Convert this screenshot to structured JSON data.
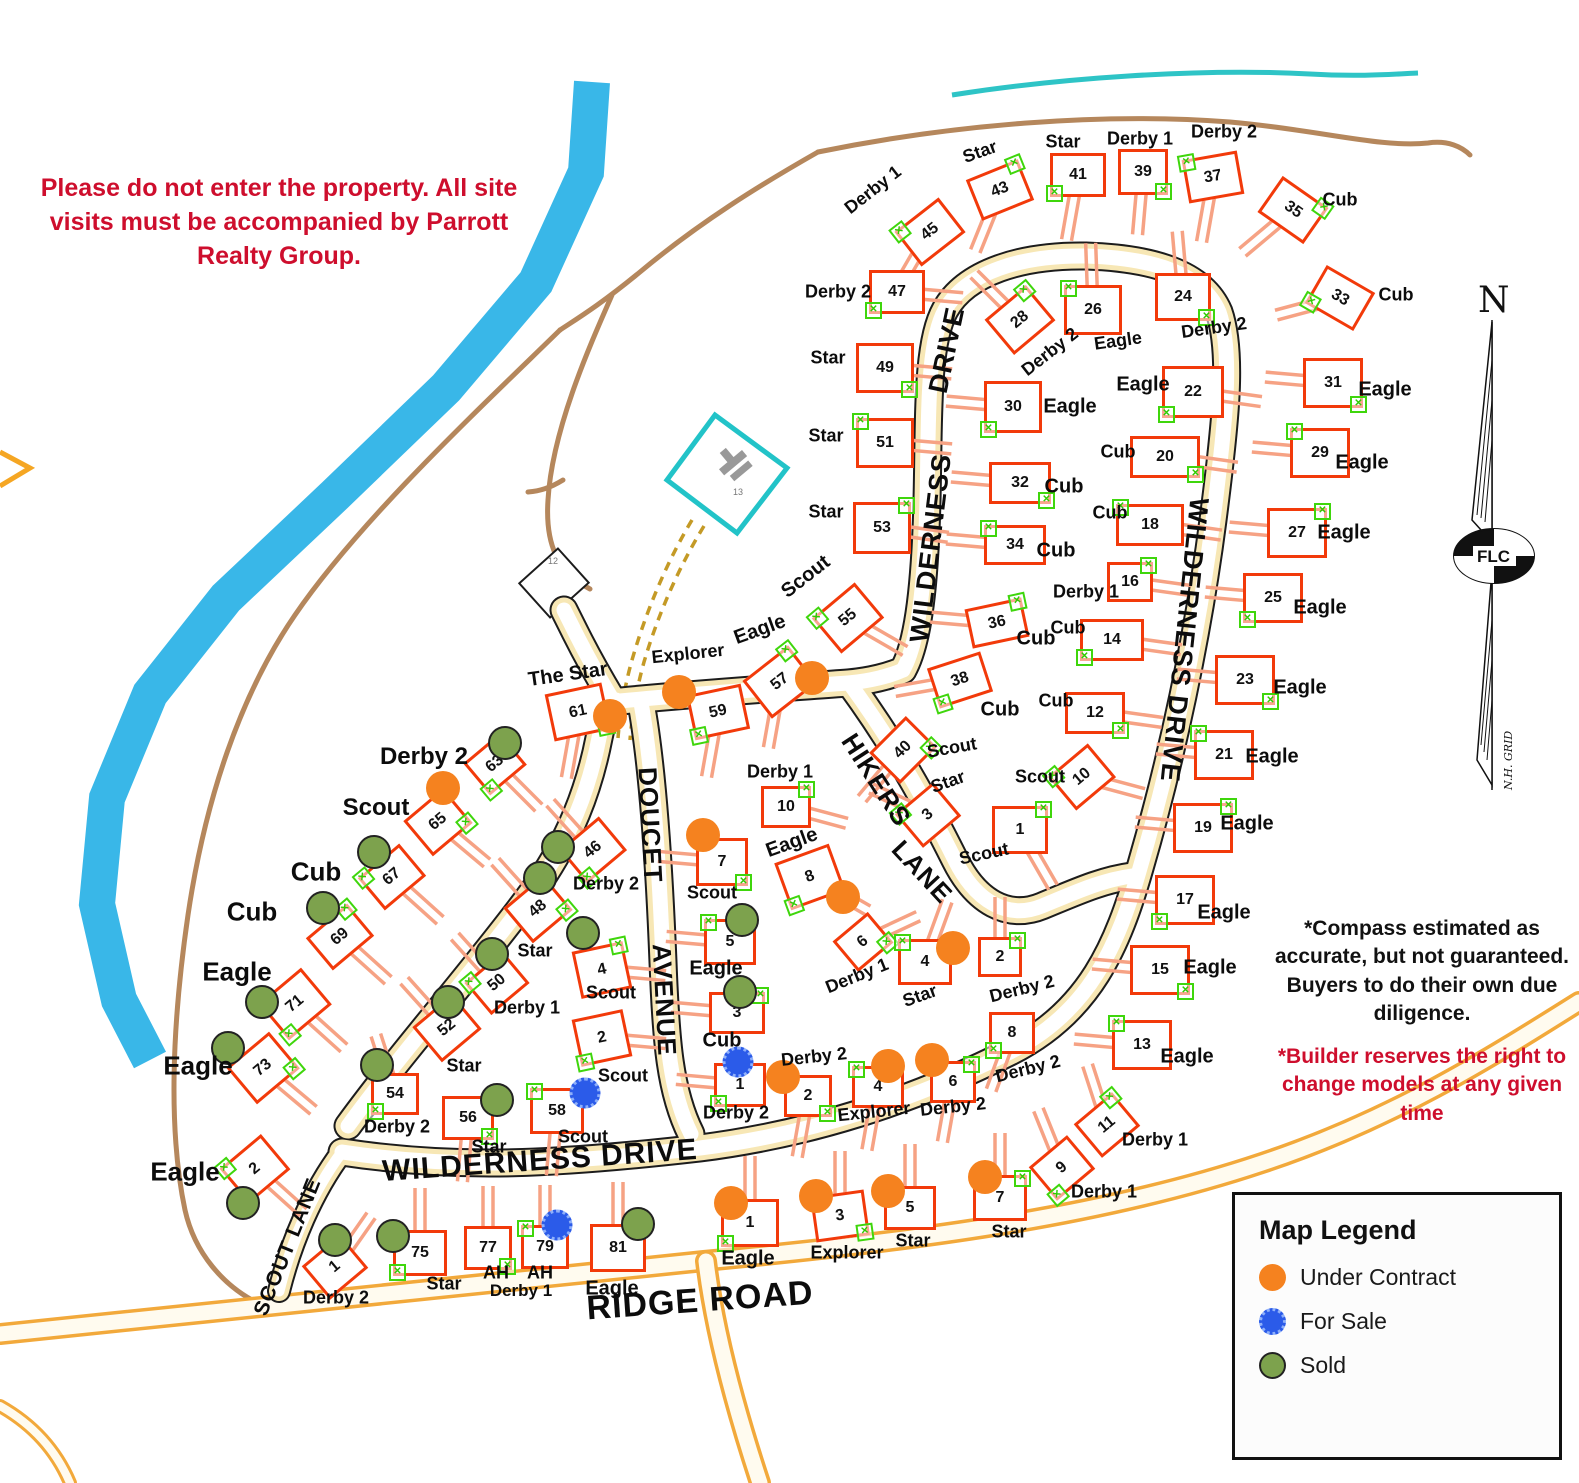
{
  "notices": {
    "entry": "Please do not enter the property. All site visits must be accompanied by Parrott Realty Group.",
    "compass_note": "*Compass estimated as accurate, but not guaranteed. Buyers to do their own due diligence.",
    "builder_note": "*Builder reserves the right to change models at any given time"
  },
  "legend": {
    "title": "Map Legend",
    "items": [
      {
        "label": "Under Contract",
        "color": "#F5821F",
        "style": "solid"
      },
      {
        "label": "For Sale",
        "color": "#2B5BE9",
        "style": "spiky"
      },
      {
        "label": "Sold",
        "color": "#7DA24D",
        "style": "outlined"
      }
    ]
  },
  "compass": {
    "north": "N",
    "oval": "FLC",
    "grid": "N.H. GRID"
  },
  "colors": {
    "house_outline": "#F23A0A",
    "driveway": "#F6A284",
    "river": "#39B7E8",
    "trail": "#B5875C",
    "stream": "#2EC4C6",
    "pond": "#22C3C8"
  },
  "road_labels": [
    {
      "t": "WILDERNESS DRIVE",
      "x": 540,
      "y": 1161,
      "r": -4,
      "s": 30
    },
    {
      "t": "WILDERNESS",
      "x": 931,
      "y": 548,
      "r": -83,
      "s": 27
    },
    {
      "t": "DRIVE",
      "x": 947,
      "y": 350,
      "r": -78,
      "s": 27
    },
    {
      "t": "WILDERNESS DRIVE",
      "x": 1184,
      "y": 640,
      "r": 96,
      "s": 27
    },
    {
      "t": "DOUCET",
      "x": 650,
      "y": 825,
      "r": 87,
      "s": 26
    },
    {
      "t": "AVENUE",
      "x": 664,
      "y": 1000,
      "r": 87,
      "s": 26
    },
    {
      "t": "HIKERS",
      "x": 876,
      "y": 780,
      "r": 57,
      "s": 26
    },
    {
      "t": "LANE",
      "x": 922,
      "y": 872,
      "r": 47,
      "s": 26
    },
    {
      "t": "SCOUT LANE",
      "x": 288,
      "y": 1247,
      "r": -68,
      "s": 21
    },
    {
      "t": "RIDGE ROAD",
      "x": 700,
      "y": 1301,
      "r": -4,
      "s": 34
    }
  ],
  "annotations": [
    {
      "t": "Derby 1",
      "x": 521,
      "y": 1291,
      "s": 17,
      "c": "#0d0d0d",
      "b": true
    },
    {
      "t": "12",
      "x": 553,
      "y": 561,
      "s": 9,
      "c": "#777",
      "b": false
    },
    {
      "t": "13",
      "x": 738,
      "y": 492,
      "s": 9,
      "c": "#777",
      "b": false
    }
  ],
  "lots": [
    {
      "n": "45",
      "m": "Derby 1",
      "x": 930,
      "y": 232,
      "r": -38,
      "da": 120,
      "lx": 873,
      "ly": 190,
      "lr": -38
    },
    {
      "n": "43",
      "m": "Star",
      "x": 1000,
      "y": 190,
      "r": -22,
      "da": 112,
      "lx": 980,
      "ly": 152,
      "lr": -20
    },
    {
      "n": "41",
      "m": "Star",
      "x": 1078,
      "y": 175,
      "r": 0,
      "da": 100,
      "lx": 1063,
      "ly": 142
    },
    {
      "n": "39",
      "m": "Derby 1",
      "x": 1143,
      "y": 172,
      "r": 0,
      "w": 50,
      "h": 46,
      "da": 95,
      "lx": 1140,
      "ly": 139
    },
    {
      "n": "37",
      "m": "Derby 2",
      "x": 1213,
      "y": 177,
      "r": -10,
      "da": 100,
      "lx": 1224,
      "ly": 132
    },
    {
      "n": "35",
      "m": "Cub",
      "x": 1293,
      "y": 210,
      "r": 35,
      "da": 140,
      "lx": 1340,
      "ly": 200
    },
    {
      "n": "33",
      "m": "Cub",
      "x": 1340,
      "y": 298,
      "r": 30,
      "da": 165,
      "lx": 1396,
      "ly": 295
    },
    {
      "n": "31",
      "m": "Eagle",
      "x": 1333,
      "y": 383,
      "r": 0,
      "w": 60,
      "h": 50,
      "da": 185,
      "lx": 1385,
      "ly": 390,
      "ls": 20
    },
    {
      "n": "29",
      "m": "Eagle",
      "x": 1320,
      "y": 453,
      "r": 0,
      "w": 60,
      "h": 50,
      "da": 185,
      "lx": 1362,
      "ly": 463,
      "ls": 20
    },
    {
      "n": "27",
      "m": "Eagle",
      "x": 1297,
      "y": 533,
      "r": 0,
      "w": 60,
      "h": 50,
      "da": 185,
      "lx": 1344,
      "ly": 533,
      "ls": 20
    },
    {
      "n": "25",
      "m": "Eagle",
      "x": 1273,
      "y": 598,
      "r": 0,
      "w": 60,
      "h": 50,
      "da": 185,
      "lx": 1320,
      "ly": 608,
      "ls": 20
    },
    {
      "n": "23",
      "m": "Eagle",
      "x": 1245,
      "y": 680,
      "r": 0,
      "w": 60,
      "h": 50,
      "da": 185,
      "lx": 1300,
      "ly": 688,
      "ls": 20
    },
    {
      "n": "21",
      "m": "Eagle",
      "x": 1224,
      "y": 755,
      "r": 0,
      "w": 60,
      "h": 50,
      "da": 185,
      "lx": 1272,
      "ly": 757,
      "ls": 20
    },
    {
      "n": "19",
      "m": "Eagle",
      "x": 1203,
      "y": 828,
      "r": 0,
      "w": 60,
      "h": 50,
      "da": 185,
      "lx": 1247,
      "ly": 824,
      "ls": 20
    },
    {
      "n": "17",
      "m": "Eagle",
      "x": 1185,
      "y": 900,
      "r": 0,
      "w": 60,
      "h": 50,
      "da": 185,
      "lx": 1224,
      "ly": 913,
      "ls": 20
    },
    {
      "n": "15",
      "m": "Eagle",
      "x": 1160,
      "y": 970,
      "r": 0,
      "w": 60,
      "h": 50,
      "da": 185,
      "lx": 1210,
      "ly": 968,
      "ls": 20
    },
    {
      "n": "13",
      "m": "Eagle",
      "x": 1142,
      "y": 1045,
      "r": 0,
      "w": 60,
      "h": 50,
      "da": 185,
      "lx": 1187,
      "ly": 1057,
      "ls": 20
    },
    {
      "n": "11",
      "m": "Derby 1",
      "x": 1107,
      "y": 1125,
      "r": -40,
      "w": 50,
      "h": 44,
      "da": 252,
      "lx": 1155,
      "ly": 1140
    },
    {
      "n": "9",
      "m": "Derby 1",
      "x": 1062,
      "y": 1168,
      "r": -40,
      "w": 50,
      "h": 44,
      "da": 248,
      "lx": 1104,
      "ly": 1192
    },
    {
      "n": "24",
      "m": "Derby 2",
      "x": 1183,
      "y": 297,
      "r": 0,
      "w": 56,
      "h": 48,
      "da": 265,
      "lx": 1214,
      "ly": 328,
      "lr": -8
    },
    {
      "n": "26",
      "m": "Eagle",
      "x": 1093,
      "y": 310,
      "r": 0,
      "w": 58,
      "h": 50,
      "da": 268,
      "lx": 1118,
      "ly": 341,
      "lr": -8
    },
    {
      "n": "28",
      "m": "Derby 2",
      "x": 1020,
      "y": 320,
      "r": -40,
      "w": 54,
      "h": 46,
      "da": 225,
      "lx": 1050,
      "ly": 352,
      "lr": -38
    },
    {
      "n": "22",
      "m": "Eagle",
      "x": 1193,
      "y": 392,
      "r": 0,
      "w": 62,
      "h": 52,
      "da": 8,
      "lx": 1143,
      "ly": 385,
      "ls": 20
    },
    {
      "n": "20",
      "m": "Cub",
      "x": 1165,
      "y": 457,
      "r": 0,
      "w": 70,
      "h": 42,
      "da": 8,
      "lx": 1118,
      "ly": 452
    },
    {
      "n": "18",
      "m": "Cub",
      "x": 1150,
      "y": 525,
      "r": 0,
      "w": 68,
      "h": 42,
      "da": 8,
      "lx": 1110,
      "ly": 513
    },
    {
      "n": "16",
      "m": "Derby 1",
      "x": 1130,
      "y": 582,
      "r": 0,
      "w": 46,
      "h": 40,
      "da": 8,
      "lx": 1086,
      "ly": 592
    },
    {
      "n": "14",
      "m": "Cub",
      "x": 1112,
      "y": 640,
      "r": 0,
      "w": 64,
      "h": 42,
      "da": 8,
      "lx": 1068,
      "ly": 628
    },
    {
      "n": "12",
      "m": "Cub",
      "x": 1095,
      "y": 713,
      "r": 0,
      "w": 60,
      "h": 42,
      "da": 8,
      "lx": 1056,
      "ly": 701
    },
    {
      "n": "10",
      "m": "Scout",
      "x": 1082,
      "y": 777,
      "r": -40,
      "w": 52,
      "h": 44,
      "da": 15,
      "lx": 1040,
      "ly": 777
    },
    {
      "n": "1",
      "m": "Scout",
      "x": 1020,
      "y": 830,
      "r": 0,
      "w": 56,
      "h": 48,
      "da": 60,
      "lx": 984,
      "ly": 854,
      "lr": -12
    },
    {
      "n": "47",
      "m": "Derby 2",
      "x": 897,
      "y": 292,
      "r": 0,
      "da": 5,
      "lx": 838,
      "ly": 292
    },
    {
      "n": "49",
      "m": "Star",
      "x": 885,
      "y": 368,
      "r": 0,
      "w": 58,
      "h": 50,
      "da": 5,
      "lx": 828,
      "ly": 358
    },
    {
      "n": "51",
      "m": "Star",
      "x": 885,
      "y": 443,
      "r": 0,
      "w": 58,
      "h": 50,
      "da": 5,
      "lx": 826,
      "ly": 436
    },
    {
      "n": "53",
      "m": "Star",
      "x": 882,
      "y": 528,
      "r": 0,
      "w": 58,
      "h": 52,
      "da": 8,
      "lx": 826,
      "ly": 512
    },
    {
      "n": "30",
      "m": "Eagle",
      "x": 1013,
      "y": 407,
      "r": 0,
      "w": 58,
      "h": 52,
      "da": 185,
      "lx": 1070,
      "ly": 407,
      "ls": 20
    },
    {
      "n": "32",
      "m": "Cub",
      "x": 1020,
      "y": 483,
      "r": 0,
      "w": 62,
      "h": 42,
      "da": 185,
      "lx": 1064,
      "ly": 487,
      "ls": 20
    },
    {
      "n": "34",
      "m": "Cub",
      "x": 1015,
      "y": 545,
      "r": 0,
      "w": 62,
      "h": 40,
      "da": 185,
      "lx": 1056,
      "ly": 551,
      "ls": 20
    },
    {
      "n": "36",
      "m": "Cub",
      "x": 997,
      "y": 623,
      "r": -12,
      "w": 58,
      "h": 40,
      "da": 185,
      "lx": 1036,
      "ly": 639,
      "ls": 20
    },
    {
      "n": "38",
      "m": "Cub",
      "x": 960,
      "y": 680,
      "r": -18,
      "w": 56,
      "h": 42,
      "da": 170,
      "lx": 1000,
      "ly": 710,
      "ls": 20
    },
    {
      "n": "40",
      "m": "Scout",
      "x": 903,
      "y": 750,
      "r": -45,
      "w": 52,
      "h": 44,
      "da": 130,
      "lx": 952,
      "ly": 748,
      "lr": -10
    },
    {
      "n": "55",
      "m": "Scout",
      "x": 848,
      "y": 618,
      "r": -40,
      "w": 56,
      "h": 46,
      "da": 30,
      "lx": 806,
      "ly": 577,
      "lr": -38,
      "ls": 20
    },
    {
      "n": "57",
      "m": "Eagle",
      "s": "uc",
      "dx": 812,
      "dy": 678,
      "x": 780,
      "y": 682,
      "r": -38,
      "w": 58,
      "h": 48,
      "da": 100,
      "lx": 760,
      "ly": 630,
      "lr": -20,
      "ls": 20
    },
    {
      "n": "59",
      "m": "Explorer",
      "s": "uc",
      "dx": 679,
      "dy": 692,
      "x": 718,
      "y": 712,
      "r": -12,
      "w": 56,
      "h": 46,
      "da": 100,
      "lx": 688,
      "ly": 654,
      "lr": -6
    },
    {
      "n": "61",
      "m": "The Star",
      "s": "uc",
      "dx": 610,
      "dy": 716,
      "x": 578,
      "y": 712,
      "r": -12,
      "w": 58,
      "h": 48,
      "da": 100,
      "lx": 568,
      "ly": 675,
      "lr": -8,
      "ls": 20
    },
    {
      "n": "3",
      "m": "Star",
      "x": 928,
      "y": 815,
      "r": -40,
      "w": 50,
      "h": 44,
      "da": 205,
      "lx": 948,
      "ly": 782,
      "lr": -20
    },
    {
      "n": "10",
      "m": "Derby 1",
      "x": 786,
      "y": 807,
      "r": 0,
      "w": 50,
      "h": 42,
      "da": 15,
      "lx": 780,
      "ly": 772
    },
    {
      "n": "8",
      "m": "Eagle",
      "s": "uc",
      "dx": 843,
      "dy": 897,
      "x": 810,
      "y": 877,
      "r": -20,
      "w": 58,
      "h": 50,
      "da": 30,
      "lx": 792,
      "ly": 843,
      "lr": -20,
      "ls": 20
    },
    {
      "n": "6",
      "m": "Derby 1",
      "x": 863,
      "y": 942,
      "r": -40,
      "w": 46,
      "h": 40,
      "da": 335,
      "lx": 857,
      "ly": 976,
      "lr": -22
    },
    {
      "n": "4",
      "m": "Star",
      "s": "uc",
      "dx": 953,
      "dy": 948,
      "x": 925,
      "y": 962,
      "r": 0,
      "w": 54,
      "h": 46,
      "da": 290,
      "lx": 920,
      "ly": 996,
      "lr": -20
    },
    {
      "n": "2",
      "m": "Derby 2",
      "x": 1000,
      "y": 957,
      "r": 0,
      "w": 44,
      "h": 40,
      "da": 270,
      "lx": 1022,
      "ly": 989,
      "lr": -14
    },
    {
      "n": "8",
      "m": "Derby 2",
      "x": 1012,
      "y": 1033,
      "r": 0,
      "w": 46,
      "h": 42,
      "da": 110,
      "lx": 1028,
      "ly": 1069,
      "lr": -14
    },
    {
      "n": "7",
      "m": "Scout",
      "s": "uc",
      "dx": 703,
      "dy": 835,
      "x": 722,
      "y": 862,
      "r": 0,
      "w": 52,
      "h": 48,
      "da": 185,
      "lx": 712,
      "ly": 893
    },
    {
      "n": "5",
      "m": "Eagle",
      "s": "sold",
      "dx": 742,
      "dy": 920,
      "x": 730,
      "y": 942,
      "r": 0,
      "w": 52,
      "h": 46,
      "da": 185,
      "lx": 716,
      "ly": 969,
      "ls": 20
    },
    {
      "n": "3",
      "m": "Cub",
      "s": "sold",
      "dx": 740,
      "dy": 992,
      "x": 737,
      "y": 1013,
      "r": 0,
      "w": 56,
      "h": 42,
      "da": 185,
      "lx": 722,
      "ly": 1041,
      "ls": 20
    },
    {
      "n": "1",
      "m": "Derby 2",
      "s": "fs",
      "dx": 738,
      "dy": 1062,
      "x": 740,
      "y": 1085,
      "r": 0,
      "w": 52,
      "h": 44,
      "da": 185,
      "lx": 736,
      "ly": 1113
    },
    {
      "n": "2",
      "m": "Derby 2",
      "s": "uc",
      "dx": 783,
      "dy": 1077,
      "x": 808,
      "y": 1096,
      "r": 0,
      "w": 48,
      "h": 42,
      "da": 100,
      "lx": 814,
      "ly": 1057,
      "lr": -6
    },
    {
      "n": "4",
      "m": "Explorer",
      "s": "uc",
      "dx": 888,
      "dy": 1066,
      "x": 878,
      "y": 1087,
      "r": 0,
      "w": 52,
      "h": 42,
      "da": 100,
      "lx": 874,
      "ly": 1112,
      "lr": -6
    },
    {
      "n": "6",
      "m": "Derby 2",
      "s": "uc",
      "dx": 932,
      "dy": 1060,
      "x": 953,
      "y": 1082,
      "r": 0,
      "w": 46,
      "h": 42,
      "da": 100,
      "lx": 953,
      "ly": 1107,
      "lr": -6
    },
    {
      "n": "1",
      "m": "Eagle",
      "s": "uc",
      "dx": 731,
      "dy": 1203,
      "x": 750,
      "y": 1223,
      "r": 0,
      "w": 58,
      "h": 48,
      "da": 270,
      "lx": 748,
      "ly": 1259,
      "ls": 20
    },
    {
      "n": "3",
      "m": "Explorer",
      "s": "uc",
      "dx": 816,
      "dy": 1196,
      "x": 840,
      "y": 1216,
      "r": -8,
      "w": 54,
      "h": 46,
      "da": 270,
      "lx": 847,
      "ly": 1253
    },
    {
      "n": "5",
      "m": "Star",
      "s": "uc",
      "dx": 888,
      "dy": 1191,
      "x": 910,
      "y": 1208,
      "r": 0,
      "w": 52,
      "h": 44,
      "da": 270,
      "lx": 913,
      "ly": 1241
    },
    {
      "n": "7",
      "m": "Star",
      "s": "uc",
      "dx": 985,
      "dy": 1177,
      "x": 1000,
      "y": 1198,
      "r": 0,
      "w": 54,
      "h": 46,
      "da": 270,
      "lx": 1009,
      "ly": 1232
    },
    {
      "n": "63",
      "m": "Derby 2",
      "s": "sold",
      "dx": 505,
      "dy": 743,
      "x": 495,
      "y": 764,
      "r": -40,
      "w": 48,
      "h": 42,
      "da": 45,
      "lx": 424,
      "ly": 757,
      "ls": 24
    },
    {
      "n": "65",
      "m": "Scout",
      "s": "uc",
      "dx": 443,
      "dy": 788,
      "x": 438,
      "y": 822,
      "r": -40,
      "w": 52,
      "h": 46,
      "da": 40,
      "lx": 376,
      "ly": 808,
      "ls": 24
    },
    {
      "n": "67",
      "m": "Cub",
      "s": "sold",
      "dx": 374,
      "dy": 852,
      "x": 392,
      "y": 877,
      "r": -40,
      "w": 54,
      "h": 42,
      "da": 42,
      "lx": 316,
      "ly": 872,
      "ls": 26
    },
    {
      "n": "69",
      "m": "Cub",
      "s": "sold",
      "dx": 323,
      "dy": 908,
      "x": 340,
      "y": 937,
      "r": -40,
      "w": 54,
      "h": 42,
      "da": 42,
      "lx": 252,
      "ly": 912,
      "ls": 26
    },
    {
      "n": "71",
      "m": "Eagle",
      "s": "sold",
      "dx": 262,
      "dy": 1002,
      "x": 295,
      "y": 1004,
      "r": -40,
      "w": 56,
      "h": 48,
      "da": 42,
      "lx": 237,
      "ly": 972,
      "ls": 26
    },
    {
      "n": "73",
      "m": "Eagle",
      "s": "sold",
      "dx": 228,
      "dy": 1048,
      "x": 263,
      "y": 1068,
      "r": -40,
      "w": 56,
      "h": 48,
      "da": 40,
      "lx": 198,
      "ly": 1066,
      "ls": 26
    },
    {
      "n": "2",
      "m": "Eagle",
      "s": "sold",
      "dx": 243,
      "dy": 1203,
      "x": 255,
      "y": 1169,
      "r": -40,
      "w": 54,
      "h": 46,
      "da": 42,
      "lx": 185,
      "ly": 1172,
      "ls": 26
    },
    {
      "n": "1",
      "m": "Derby 2",
      "s": "sold",
      "dx": 335,
      "dy": 1240,
      "x": 335,
      "y": 1267,
      "r": -40,
      "w": 50,
      "h": 44,
      "da": 305,
      "lx": 336,
      "ly": 1298
    },
    {
      "n": "75",
      "m": "Star",
      "s": "sold",
      "dx": 393,
      "dy": 1236,
      "x": 420,
      "y": 1253,
      "r": 0,
      "w": 54,
      "h": 46,
      "da": 270,
      "lx": 444,
      "ly": 1284
    },
    {
      "n": "77",
      "m": "AH",
      "x": 488,
      "y": 1248,
      "r": 0,
      "w": 48,
      "h": 44,
      "da": 270,
      "lx": 496,
      "ly": 1273
    },
    {
      "n": "79",
      "m": "AH",
      "s": "fs",
      "dx": 557,
      "dy": 1225,
      "x": 545,
      "y": 1247,
      "r": 0,
      "w": 48,
      "h": 44,
      "da": 270,
      "lx": 540,
      "ly": 1273
    },
    {
      "n": "81",
      "m": "Eagle",
      "s": "sold",
      "dx": 638,
      "dy": 1224,
      "x": 618,
      "y": 1248,
      "r": 0,
      "w": 56,
      "h": 48,
      "da": 270,
      "lx": 612,
      "ly": 1289,
      "ls": 20
    },
    {
      "n": "46",
      "m": "Derby 2",
      "s": "sold",
      "dx": 558,
      "dy": 847,
      "x": 593,
      "y": 850,
      "r": -40,
      "w": 52,
      "h": 44,
      "da": 228,
      "lx": 606,
      "ly": 884
    },
    {
      "n": "48",
      "m": "Star",
      "s": "sold",
      "dx": 540,
      "dy": 878,
      "x": 538,
      "y": 909,
      "r": -40,
      "w": 52,
      "h": 46,
      "da": 228,
      "lx": 535,
      "ly": 951
    },
    {
      "n": "50",
      "m": "Derby 1",
      "s": "sold",
      "dx": 492,
      "dy": 954,
      "x": 497,
      "y": 983,
      "r": -40,
      "w": 50,
      "h": 42,
      "da": 228,
      "lx": 527,
      "ly": 1008
    },
    {
      "n": "52",
      "m": "Star",
      "s": "sold",
      "dx": 448,
      "dy": 1002,
      "x": 447,
      "y": 1028,
      "r": -40,
      "w": 52,
      "h": 46,
      "da": 228,
      "lx": 464,
      "ly": 1066
    },
    {
      "n": "54",
      "m": "Derby 2",
      "s": "sold",
      "dx": 377,
      "dy": 1065,
      "x": 395,
      "y": 1094,
      "r": 0,
      "w": 48,
      "h": 42,
      "da": 252,
      "lx": 397,
      "ly": 1127
    },
    {
      "n": "56",
      "m": "Star",
      "s": "sold",
      "dx": 497,
      "dy": 1100,
      "x": 468,
      "y": 1118,
      "r": 0,
      "w": 52,
      "h": 44,
      "da": 95,
      "lx": 489,
      "ly": 1147
    },
    {
      "n": "58",
      "m": "Scout",
      "s": "fs",
      "dx": 585,
      "dy": 1093,
      "x": 557,
      "y": 1111,
      "r": 0,
      "w": 54,
      "h": 46,
      "da": 95,
      "lx": 583,
      "ly": 1137
    },
    {
      "n": "4",
      "m": "Scout",
      "s": "sold",
      "dx": 583,
      "dy": 933,
      "x": 602,
      "y": 970,
      "r": -12,
      "w": 52,
      "h": 48,
      "da": 5,
      "lx": 611,
      "ly": 993
    },
    {
      "n": "2",
      "m": "Scout",
      "x": 602,
      "y": 1038,
      "r": -12,
      "w": 52,
      "h": 48,
      "da": 5,
      "lx": 623,
      "ly": 1076
    }
  ]
}
